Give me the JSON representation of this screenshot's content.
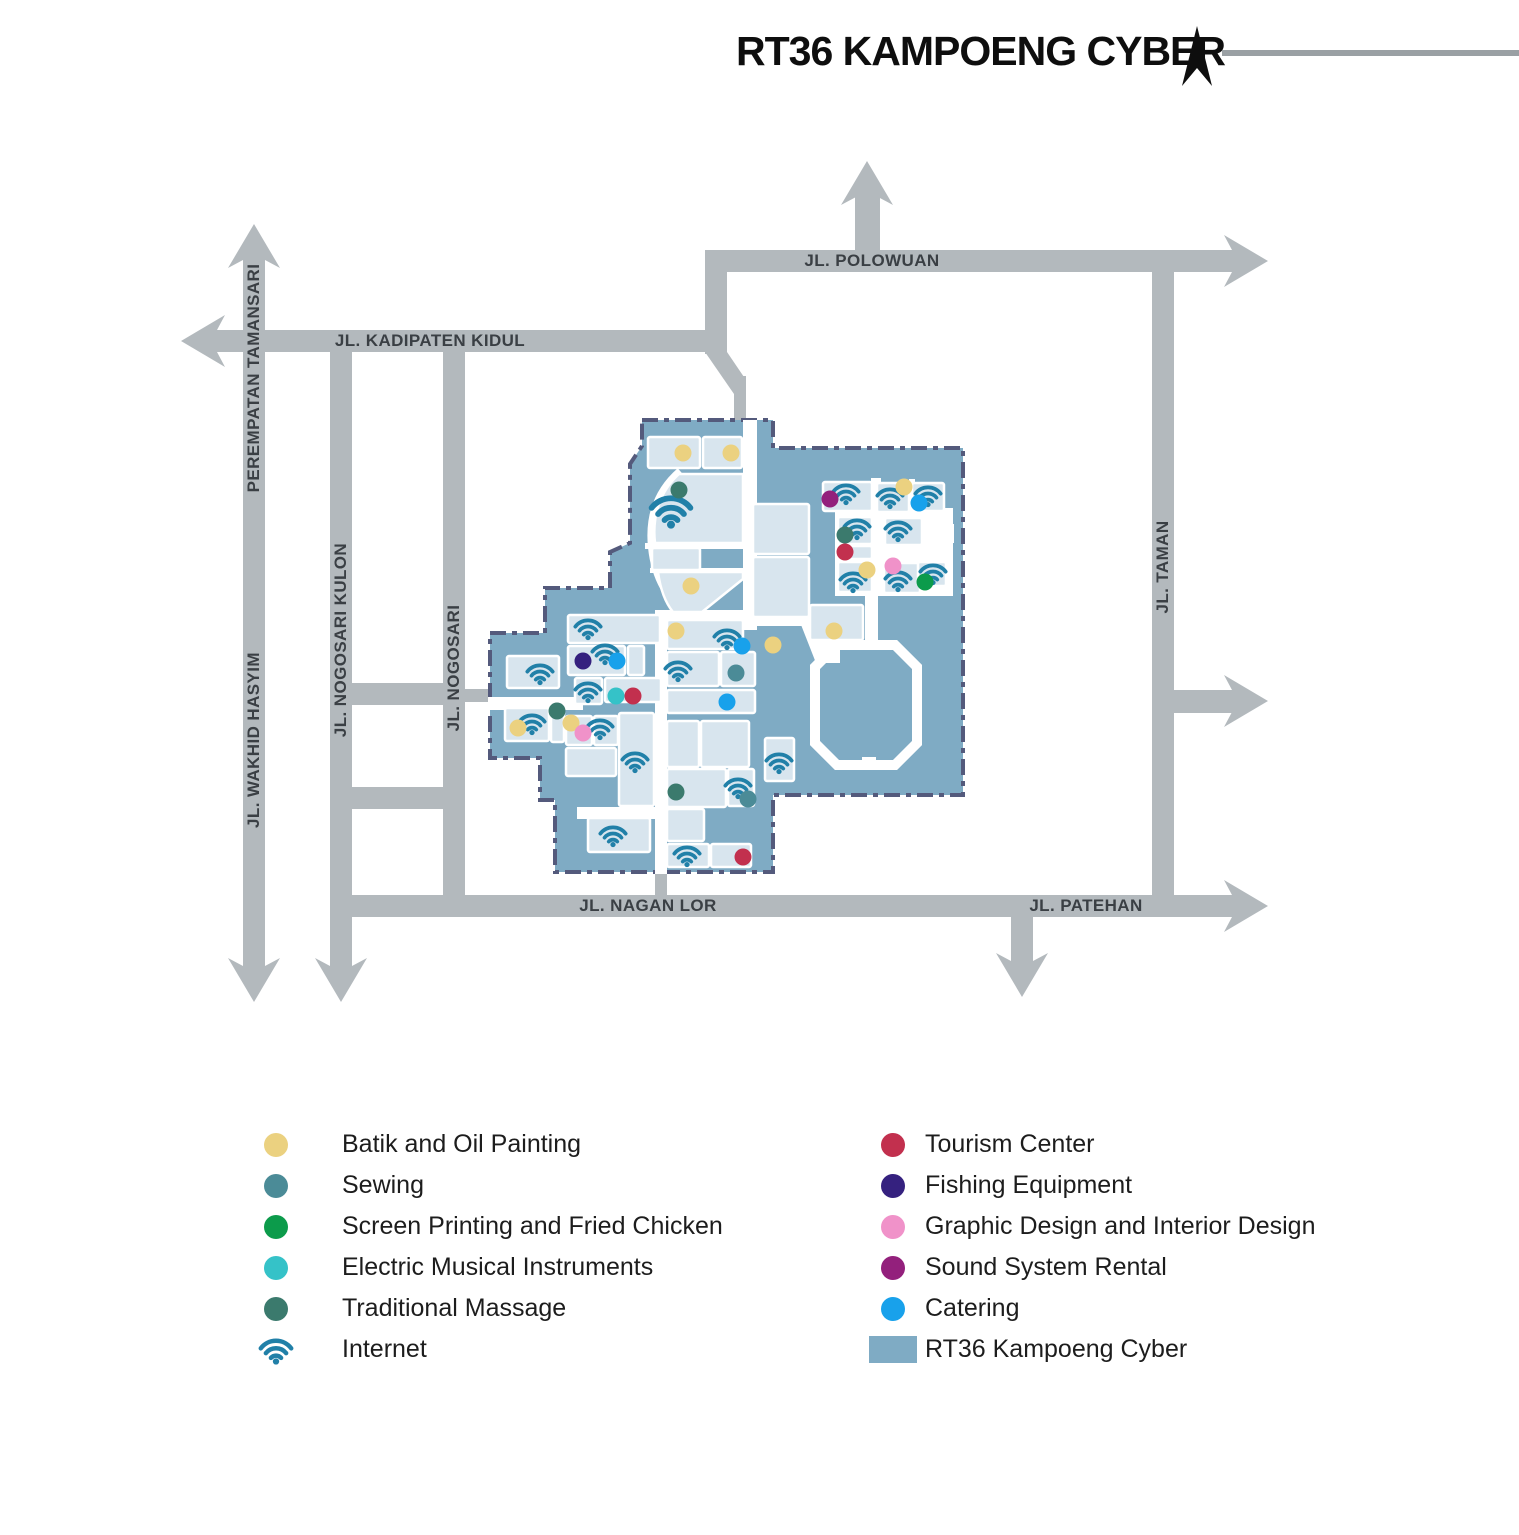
{
  "header": {
    "title": "RT36 KAMPOENG CYBER"
  },
  "colors": {
    "road": "#b3b9bd",
    "region": "#7fabc4",
    "building": "#d8e5ee",
    "region_border": "#545a7c",
    "header_line": "#9aa0a4",
    "categories": {
      "batik": "#ebd180",
      "sewing": "#4b8b97",
      "screen_printing": "#0c9b4b",
      "electric": "#35c2c8",
      "massage": "#3b7a6d",
      "internet": "#2180a8",
      "tourism": "#c2304e",
      "fishing": "#35217f",
      "graphic": "#f092c9",
      "sound": "#93207c",
      "catering": "#18a1eb"
    }
  },
  "roads": {
    "labels": [
      {
        "text": "PEREMPATAN TAMANSARI",
        "x": 254,
        "y": 378,
        "vert": true
      },
      {
        "text": "JL. WAKHID HASYIM",
        "x": 254,
        "y": 740,
        "vert": true
      },
      {
        "text": "JL. NOGOSARI KULON",
        "x": 341,
        "y": 640,
        "vert": true
      },
      {
        "text": "JL. NOGOSARI",
        "x": 454,
        "y": 668,
        "vert": true
      },
      {
        "text": "JL. KADIPATEN KIDUL",
        "x": 430,
        "y": 341,
        "vert": false
      },
      {
        "text": "JL. POLOWUAN",
        "x": 872,
        "y": 261,
        "vert": false
      },
      {
        "text": "JL. TAMAN",
        "x": 1163,
        "y": 567,
        "vert": true
      },
      {
        "text": "JL. NAGAN LOR",
        "x": 648,
        "y": 906,
        "vert": false
      },
      {
        "text": "JL. PATEHAN",
        "x": 1086,
        "y": 906,
        "vert": false
      }
    ]
  },
  "map": {
    "region_name": "RT36 Kampoeng Cyber",
    "buildings": [
      [
        648,
        437,
        52,
        31
      ],
      [
        703,
        437,
        39,
        31
      ],
      [
        652,
        548,
        48,
        22
      ],
      [
        753,
        504,
        56,
        50
      ],
      [
        753,
        557,
        56,
        60
      ],
      [
        810,
        605,
        53,
        35
      ],
      [
        823,
        482,
        49,
        29
      ],
      [
        877,
        483,
        32,
        29
      ],
      [
        912,
        483,
        32,
        28
      ],
      [
        838,
        517,
        34,
        27
      ],
      [
        838,
        546,
        34,
        13
      ],
      [
        885,
        518,
        37,
        27
      ],
      [
        838,
        562,
        34,
        30
      ],
      [
        884,
        563,
        36,
        30
      ],
      [
        918,
        562,
        28,
        24
      ],
      [
        568,
        615,
        92,
        28
      ],
      [
        568,
        646,
        57,
        29
      ],
      [
        628,
        646,
        16,
        29
      ],
      [
        507,
        656,
        52,
        32
      ],
      [
        575,
        678,
        27,
        26
      ],
      [
        605,
        678,
        56,
        24
      ],
      [
        505,
        708,
        44,
        33
      ],
      [
        551,
        704,
        13,
        38
      ],
      [
        566,
        716,
        26,
        29
      ],
      [
        594,
        716,
        24,
        29
      ],
      [
        566,
        748,
        50,
        28
      ],
      [
        619,
        713,
        35,
        93
      ],
      [
        588,
        818,
        62,
        34
      ],
      [
        667,
        620,
        76,
        29
      ],
      [
        667,
        652,
        52,
        34
      ],
      [
        721,
        652,
        34,
        34
      ],
      [
        667,
        690,
        88,
        23
      ],
      [
        667,
        721,
        32,
        46
      ],
      [
        701,
        721,
        48,
        46
      ],
      [
        667,
        769,
        59,
        38
      ],
      [
        728,
        769,
        26,
        37
      ],
      [
        667,
        809,
        37,
        32
      ],
      [
        667,
        844,
        42,
        23
      ],
      [
        711,
        844,
        40,
        23
      ],
      [
        765,
        738,
        29,
        43
      ]
    ],
    "building_paths": [
      "M 679,474 L 743,474 L 743,543 L 655,543 C 652,518 659,492 679,474 Z",
      "M 658,572 L 743,572 L 743,579 L 702,612 L 673,612 C 664,601 660,587 658,572 Z"
    ],
    "wifi_points": [
      [
        671,
        510,
        46
      ],
      [
        588,
        628
      ],
      [
        605,
        653
      ],
      [
        540,
        673
      ],
      [
        588,
        691
      ],
      [
        532,
        723
      ],
      [
        600,
        728
      ],
      [
        635,
        761
      ],
      [
        613,
        835
      ],
      [
        727,
        638
      ],
      [
        678,
        670
      ],
      [
        738,
        787
      ],
      [
        687,
        855
      ],
      [
        779,
        762
      ],
      [
        846,
        493
      ],
      [
        890,
        497
      ],
      [
        928,
        495
      ],
      [
        857,
        528
      ],
      [
        898,
        530
      ],
      [
        853,
        581
      ],
      [
        898,
        580
      ],
      [
        933,
        573
      ]
    ],
    "dots": [
      {
        "x": 683,
        "y": 453,
        "c": "batik"
      },
      {
        "x": 731,
        "y": 453,
        "c": "batik"
      },
      {
        "x": 691,
        "y": 586,
        "c": "batik"
      },
      {
        "x": 676,
        "y": 631,
        "c": "batik"
      },
      {
        "x": 773,
        "y": 645,
        "c": "batik"
      },
      {
        "x": 518,
        "y": 728,
        "c": "batik"
      },
      {
        "x": 571,
        "y": 723,
        "c": "batik"
      },
      {
        "x": 904,
        "y": 487,
        "c": "batik"
      },
      {
        "x": 867,
        "y": 570,
        "c": "batik"
      },
      {
        "x": 834,
        "y": 631,
        "c": "batik"
      },
      {
        "x": 736,
        "y": 673,
        "c": "sewing"
      },
      {
        "x": 748,
        "y": 799,
        "c": "sewing"
      },
      {
        "x": 925,
        "y": 582,
        "c": "screen_printing"
      },
      {
        "x": 616,
        "y": 696,
        "c": "electric"
      },
      {
        "x": 679,
        "y": 490,
        "c": "massage"
      },
      {
        "x": 557,
        "y": 711,
        "c": "massage"
      },
      {
        "x": 845,
        "y": 535,
        "c": "massage"
      },
      {
        "x": 676,
        "y": 792,
        "c": "massage"
      },
      {
        "x": 633,
        "y": 696,
        "c": "tourism"
      },
      {
        "x": 845,
        "y": 552,
        "c": "tourism"
      },
      {
        "x": 743,
        "y": 857,
        "c": "tourism"
      },
      {
        "x": 583,
        "y": 661,
        "c": "fishing"
      },
      {
        "x": 583,
        "y": 733,
        "c": "graphic"
      },
      {
        "x": 893,
        "y": 566,
        "c": "graphic"
      },
      {
        "x": 830,
        "y": 499,
        "c": "sound"
      },
      {
        "x": 617,
        "y": 661,
        "c": "catering"
      },
      {
        "x": 742,
        "y": 646,
        "c": "catering"
      },
      {
        "x": 727,
        "y": 702,
        "c": "catering"
      },
      {
        "x": 919,
        "y": 503,
        "c": "catering"
      }
    ]
  },
  "legend": {
    "left": [
      {
        "label": "Batik and Oil Painting",
        "marker": "dot",
        "color_key": "batik"
      },
      {
        "label": "Sewing",
        "marker": "dot",
        "color_key": "sewing"
      },
      {
        "label": "Screen Printing and Fried Chicken",
        "marker": "dot",
        "color_key": "screen_printing"
      },
      {
        "label": "Electric Musical Instruments",
        "marker": "dot",
        "color_key": "electric"
      },
      {
        "label": "Traditional Massage",
        "marker": "dot",
        "color_key": "massage"
      },
      {
        "label": "Internet",
        "marker": "wifi",
        "color_key": "internet"
      }
    ],
    "right": [
      {
        "label": "Tourism Center",
        "marker": "dot",
        "color_key": "tourism"
      },
      {
        "label": "Fishing Equipment",
        "marker": "dot",
        "color_key": "fishing"
      },
      {
        "label": "Graphic Design and Interior Design",
        "marker": "dot",
        "color_key": "graphic"
      },
      {
        "label": "Sound System Rental",
        "marker": "dot",
        "color_key": "sound"
      },
      {
        "label": "Catering",
        "marker": "dot",
        "color_key": "catering"
      },
      {
        "label": "RT36 Kampoeng Cyber",
        "marker": "square",
        "color_key": "region"
      }
    ]
  }
}
